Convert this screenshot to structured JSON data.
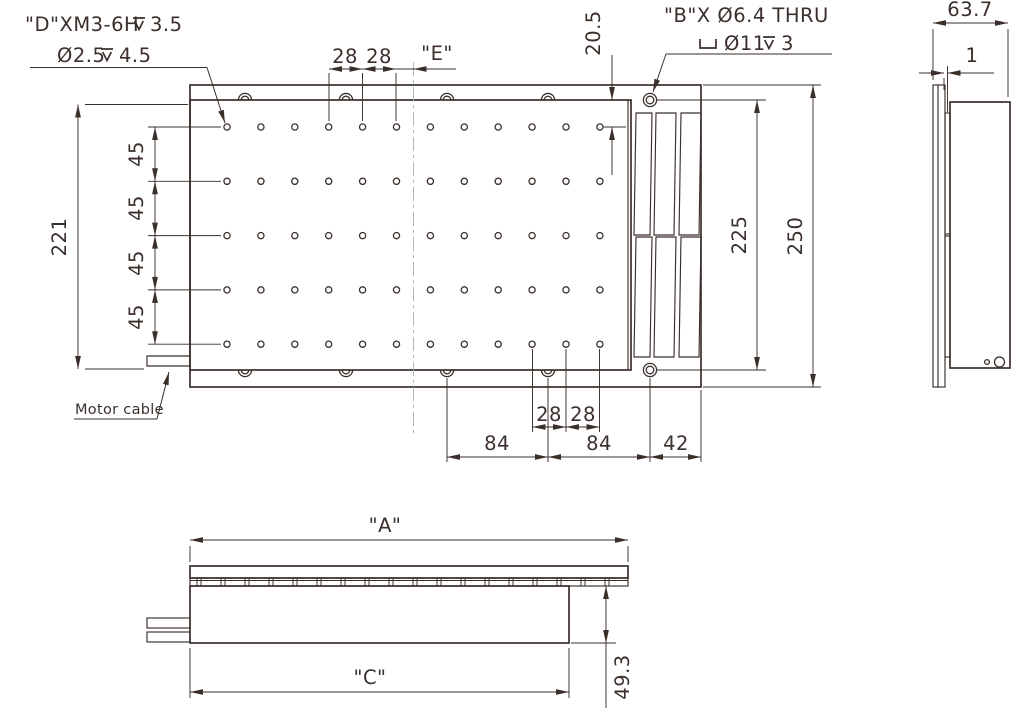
{
  "callout_d": {
    "thread": "\"D\"XM3-6H",
    "thread_depth": "3.5",
    "pilot": "Ø2.5",
    "pilot_depth": "4.5"
  },
  "callout_b": {
    "line1": "\"B\"X Ø6.4 THRU",
    "cbore_dia": "Ø11",
    "cbore_depth": "3"
  },
  "motor_cable": "Motor cable",
  "dims": {
    "plan": {
      "overall_height": "250",
      "table_height": "225",
      "left_height": "221",
      "row_pitch": [
        "45",
        "45",
        "45",
        "45"
      ],
      "top_pitch": [
        "28",
        "28"
      ],
      "e": "\"E\"",
      "edge_offset": "20.5",
      "bottom_pitch": [
        "28",
        "28"
      ],
      "bottom_chain": [
        "84",
        "84",
        "42"
      ]
    },
    "side": {
      "total_depth": "63.7",
      "plate_gap": "1"
    },
    "front": {
      "length_a": "\"A\"",
      "length_c": "\"C\"",
      "body_height": "49.3"
    }
  }
}
